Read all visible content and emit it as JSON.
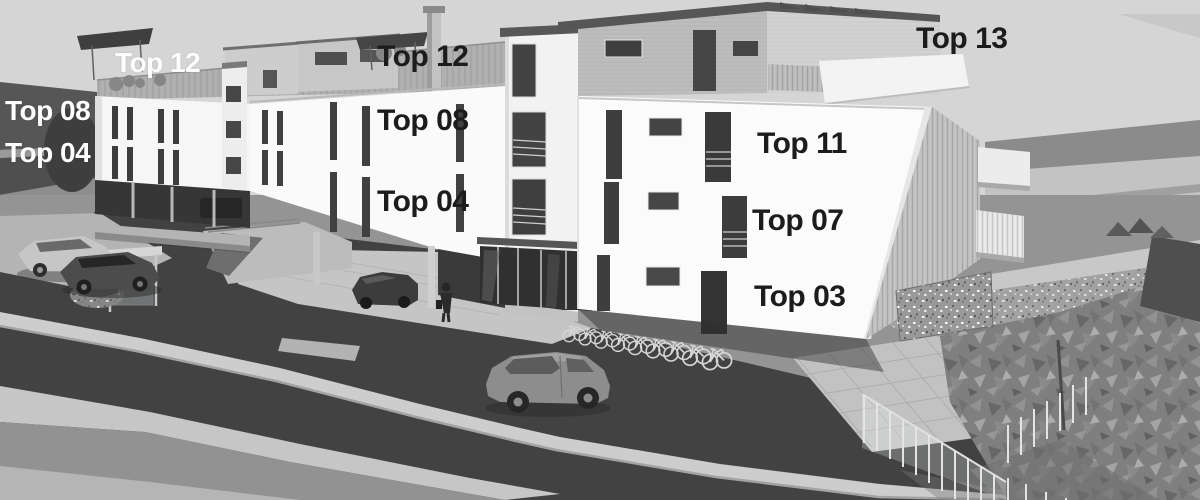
{
  "image": {
    "kind": "architectural-rendering",
    "description": "Grayscale 3D rendering of a modern multi-storey apartment complex seen from the street, with parked cars, a bus shelter, a pedestrian, a bicycle rack, gabion wall, glass balustrade and low-poly trees; apartment units are annotated with Top numbers.",
    "palette": {
      "sky": "#d5d5d5",
      "facade_white": "#fafafa",
      "asphalt_dark": "#424242",
      "curb_light": "#cdcdcd",
      "label_dark": "#1c1c1c",
      "label_light": "#fdfdfd"
    }
  },
  "unit_labels": [
    {
      "text": "Top 12",
      "tone": "light"
    },
    {
      "text": "Top 08",
      "tone": "light"
    },
    {
      "text": "Top 04",
      "tone": "light"
    },
    {
      "text": "Top 12",
      "tone": "dark"
    },
    {
      "text": "Top 08",
      "tone": "dark"
    },
    {
      "text": "Top 04",
      "tone": "dark"
    },
    {
      "text": "Top 13",
      "tone": "dark"
    },
    {
      "text": "Top 11",
      "tone": "dark"
    },
    {
      "text": "Top 07",
      "tone": "dark"
    },
    {
      "text": "Top 03",
      "tone": "dark"
    }
  ]
}
